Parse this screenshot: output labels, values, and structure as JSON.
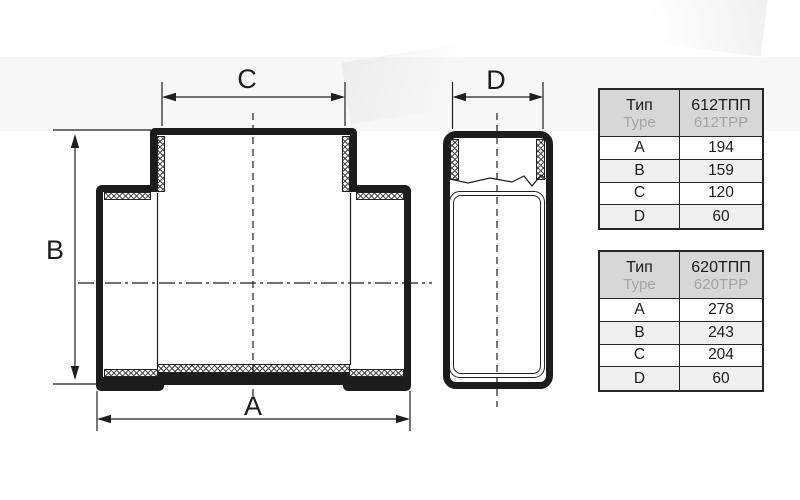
{
  "drawing": {
    "title": "tee-duct-fitting-dimension-drawing",
    "views": [
      "front-view-tee",
      "side-view-profile"
    ],
    "line_color": "#1c1c1c"
  },
  "dimensions": {
    "a": "A",
    "b": "B",
    "c": "C",
    "d": "D"
  },
  "colors": {
    "line": "#1c1c1c",
    "table_border": "#262626",
    "table_header_bg": "#d7d7d7",
    "table_alt_row_bg": "#efefef",
    "secondary_text": "#a3a3a3"
  },
  "tables": [
    {
      "header": {
        "type_primary": "Тип",
        "type_secondary": "Type",
        "model_primary": "612ТПП",
        "model_secondary": "612TPP"
      },
      "rows": [
        [
          "A",
          "194"
        ],
        [
          "B",
          "159"
        ],
        [
          "C",
          "120"
        ],
        [
          "D",
          "60"
        ]
      ]
    },
    {
      "header": {
        "type_primary": "Тип",
        "type_secondary": "Type",
        "model_primary": "620ТПП",
        "model_secondary": "620TPP"
      },
      "rows": [
        [
          "A",
          "278"
        ],
        [
          "B",
          "243"
        ],
        [
          "C",
          "204"
        ],
        [
          "D",
          "60"
        ]
      ]
    }
  ]
}
